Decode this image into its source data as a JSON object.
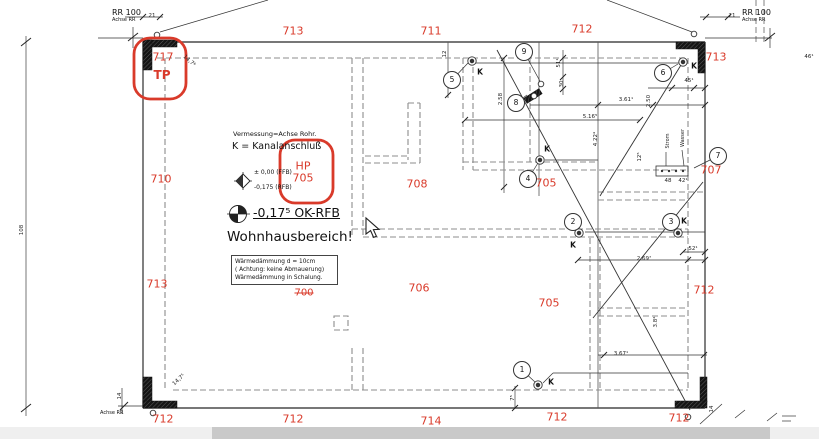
{
  "colors": {
    "red_markup": "#d93a2a",
    "wall": "#4a4a4a",
    "dashed": "#8d8d8d",
    "bar_light": "#efefef",
    "bar_dark": "#c9c9c9"
  },
  "reference_labels": {
    "top_left": {
      "title": "RR 100",
      "axis": "Achse RR",
      "offset": "21"
    },
    "top_right": {
      "title": "RR 100",
      "axis": "Achse RR",
      "offset": "21"
    },
    "bottom_left_axis": "Achse RR"
  },
  "red_markup": {
    "tp_value": "717",
    "tp_label": "TP",
    "hp_label": "HP",
    "hp_value": "705",
    "corrected_value": "700"
  },
  "legend": {
    "survey_line": "Vermessung=Achse Rohr.",
    "kanal_line": "K = Kanalanschluß",
    "level_1": "± 0,00 (FFB)",
    "level_2": "-0,175 (RFB)",
    "ok_rfb": "-0,17⁵ OK-RFB",
    "area_title": "Wohnhausbereich!",
    "note_box": [
      "Wärmedämmung d =  10cm",
      "(  Achtung: keine Abmauerung)",
      "Wärmedämmung in Schalung."
    ]
  },
  "red_dimensions": [
    {
      "t": "713",
      "x": 293,
      "y": 31
    },
    {
      "t": "711",
      "x": 431,
      "y": 31
    },
    {
      "t": "712",
      "x": 582,
      "y": 29
    },
    {
      "t": "713",
      "x": 716,
      "y": 57
    },
    {
      "t": "710",
      "x": 161,
      "y": 179
    },
    {
      "t": "713",
      "x": 157,
      "y": 284
    },
    {
      "t": "708",
      "x": 417,
      "y": 184
    },
    {
      "t": "705",
      "x": 546,
      "y": 183
    },
    {
      "t": "707",
      "x": 711,
      "y": 170
    },
    {
      "t": "706",
      "x": 419,
      "y": 288
    },
    {
      "t": "705",
      "x": 549,
      "y": 303
    },
    {
      "t": "712",
      "x": 704,
      "y": 290
    },
    {
      "t": "712",
      "x": 163,
      "y": 419
    },
    {
      "t": "712",
      "x": 293,
      "y": 419
    },
    {
      "t": "714",
      "x": 431,
      "y": 421
    },
    {
      "t": "712",
      "x": 557,
      "y": 417
    },
    {
      "t": "712",
      "x": 679,
      "y": 418
    }
  ],
  "annotations": [
    {
      "t": "21",
      "x": 152,
      "y": 16
    },
    {
      "t": "21",
      "x": 732,
      "y": 16
    },
    {
      "t": "14,7⁶",
      "x": 189,
      "y": 61,
      "r": 42
    },
    {
      "t": "12",
      "x": 445,
      "y": 54,
      "r": -90
    },
    {
      "t": "51¹",
      "x": 559,
      "y": 63,
      "r": -90
    },
    {
      "t": "30",
      "x": 562,
      "y": 84,
      "r": -90
    },
    {
      "t": "2.58",
      "x": 501,
      "y": 99,
      "r": -90
    },
    {
      "t": "45¹",
      "x": 689,
      "y": 81
    },
    {
      "t": "3.61¹",
      "x": 626,
      "y": 100
    },
    {
      "t": "2.50",
      "x": 649,
      "y": 101,
      "r": -90
    },
    {
      "t": "5.16⁵",
      "x": 590,
      "y": 117
    },
    {
      "t": "4.22⁴",
      "x": 596,
      "y": 139,
      "r": -90
    },
    {
      "t": "12⁵",
      "x": 640,
      "y": 157,
      "r": -90
    },
    {
      "t": "48",
      "x": 668,
      "y": 181
    },
    {
      "t": "42¹",
      "x": 683,
      "y": 181
    },
    {
      "t": "52¹",
      "x": 693,
      "y": 249
    },
    {
      "t": "2.69⁷",
      "x": 644,
      "y": 259
    },
    {
      "t": "3.8⁴",
      "x": 656,
      "y": 322,
      "r": -90
    },
    {
      "t": "3.67¹",
      "x": 621,
      "y": 354
    },
    {
      "t": "7⁵",
      "x": 513,
      "y": 398,
      "r": -90
    },
    {
      "t": "14,7⁵",
      "x": 179,
      "y": 380,
      "r": -42
    },
    {
      "t": "14",
      "x": 120,
      "y": 396,
      "r": -90
    },
    {
      "t": "14",
      "x": 712,
      "y": 409,
      "r": -90
    },
    {
      "t": "46¹",
      "x": 809,
      "y": 57
    },
    {
      "t": "108",
      "x": 22,
      "y": 230,
      "r": -90
    },
    {
      "t": "Strom",
      "x": 668,
      "y": 141,
      "r": -90,
      "s": 5
    },
    {
      "t": "Wasser",
      "x": 683,
      "y": 138,
      "r": -90,
      "s": 5
    }
  ],
  "markers": [
    {
      "n": "5",
      "x": 452,
      "y": 80
    },
    {
      "n": "9",
      "x": 524,
      "y": 52
    },
    {
      "n": "8",
      "x": 516,
      "y": 103
    },
    {
      "n": "6",
      "x": 663,
      "y": 73
    },
    {
      "n": "4",
      "x": 528,
      "y": 179
    },
    {
      "n": "2",
      "x": 573,
      "y": 222
    },
    {
      "n": "3",
      "x": 671,
      "y": 222
    },
    {
      "n": "7",
      "x": 718,
      "y": 156
    },
    {
      "n": "1",
      "x": 522,
      "y": 370
    }
  ],
  "k_label_text": "K",
  "k_labels": [
    {
      "x": 480,
      "y": 72
    },
    {
      "x": 694,
      "y": 66
    },
    {
      "x": 547,
      "y": 149
    },
    {
      "x": 573,
      "y": 245
    },
    {
      "x": 684,
      "y": 221
    },
    {
      "x": 551,
      "y": 382
    }
  ],
  "k_points": [
    {
      "x": 472,
      "y": 61
    },
    {
      "x": 683,
      "y": 62
    },
    {
      "x": 540,
      "y": 160
    },
    {
      "x": 579,
      "y": 233
    },
    {
      "x": 678,
      "y": 233
    },
    {
      "x": 538,
      "y": 385
    }
  ],
  "small_circles": [
    {
      "x": 157,
      "y": 35
    },
    {
      "x": 694,
      "y": 34
    },
    {
      "x": 153,
      "y": 413
    },
    {
      "x": 688,
      "y": 417
    },
    {
      "x": 541,
      "y": 84
    },
    {
      "x": 534,
      "y": 96
    }
  ]
}
